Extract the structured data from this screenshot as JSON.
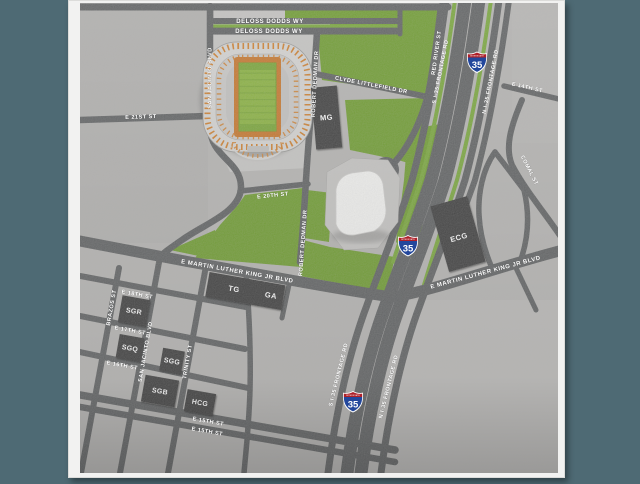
{
  "map": {
    "colors": {
      "background": "#4e6a74",
      "frame": "#f2f2f1",
      "land": "#b7b6b4",
      "road": "#5f6162",
      "park_green": "#6f9d2f",
      "median_green": "#79a83a",
      "building": "#3d3d3d",
      "stadium_orange": "#d0802e",
      "field_green": "#8ab33e",
      "erwin_white": "#f4f4f2",
      "shield_blue": "#23479c",
      "shield_red": "#ae2029"
    },
    "streets": {
      "deloss_dodds_1": "DELOSS DODDS WY",
      "deloss_dodds_2": "DELOSS DODDS WY",
      "san_jacinto_n": "SAN JACINTO BLVD",
      "san_jacinto_s": "SAN JACINTO BLVD",
      "e21st": "E 21ST ST",
      "e20th": "E 20TH ST",
      "clyde_littlefield": "CLYDE LITTLEFIELD DR",
      "robert_dedman_n": "ROBERT DEDMAN DR",
      "robert_dedman_s": "ROBERT DEDMAN DR",
      "red_river": "RED RIVER ST",
      "s_frontage_n": "S I-35 FRONTAGE RD",
      "n_frontage_n": "N I-35 FRONTAGE RD",
      "s_frontage_s": "S I-35 FRONTAGE RD",
      "n_frontage_s": "N I-35 FRONTAGE RD",
      "e14th": "E 14TH ST",
      "comal": "COMAL ST",
      "mlk_w": "E MARTIN LUTHER KING JR BLVD",
      "mlk_e": "E MARTIN LUTHER KING JR BLVD",
      "e18th": "E 18TH ST",
      "brazos": "BRAZOS ST",
      "e17th": "E 17TH ST",
      "e16th": "E 16TH ST",
      "trinity": "TRINITY ST",
      "e15th_1": "E 15TH ST",
      "e15th_2": "E 15TH ST"
    },
    "buildings": {
      "mg": "MG",
      "ecg": "ECG",
      "tg": "TG",
      "ga": "GA",
      "sgr": "SGR",
      "sgq": "SGQ",
      "sgg": "SGG",
      "sgb": "SGB",
      "hcg": "HCG"
    },
    "highway": {
      "interstate_label": "INTERSTATE",
      "number": "35"
    }
  }
}
